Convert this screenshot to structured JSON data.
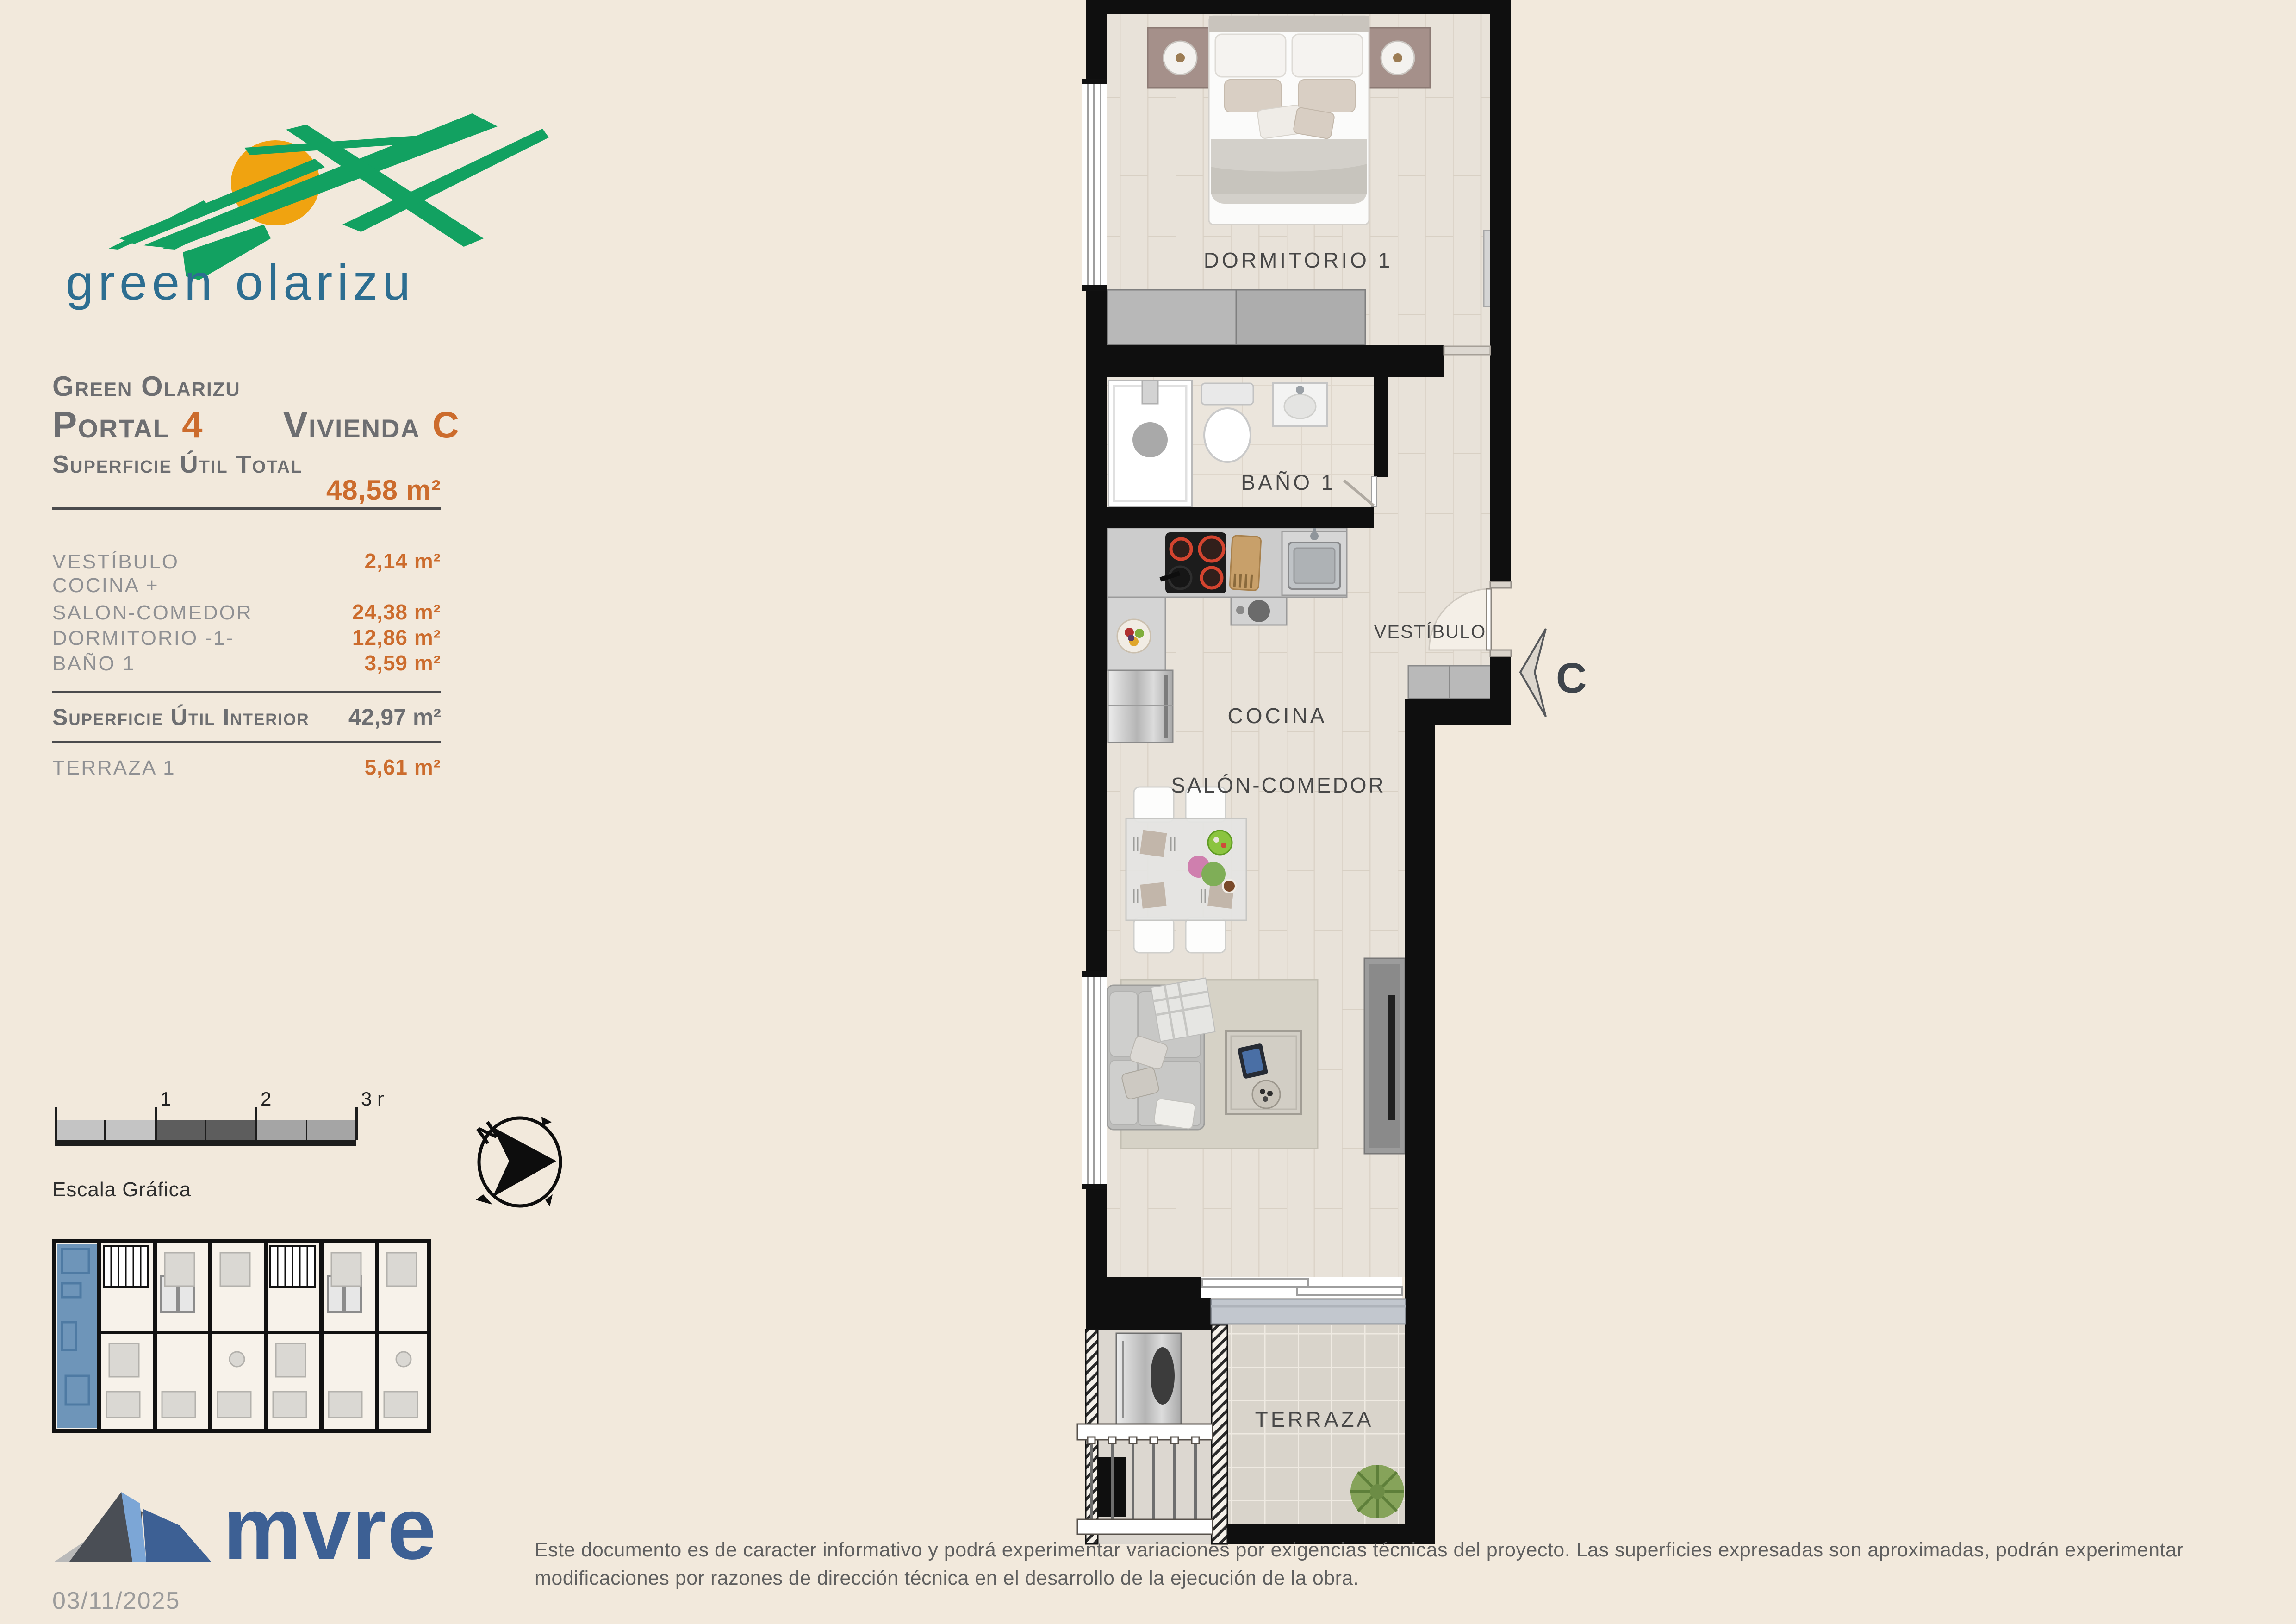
{
  "logo": {
    "brand": "green olarizu"
  },
  "info": {
    "project": "Green Olarizu",
    "portal_label": "Portal",
    "portal_number": "4",
    "vivienda_label": "Vivienda",
    "vivienda_letter": "C",
    "total_label": "Superficie Útil Total",
    "total_value": "48,58 m²",
    "rooms": [
      {
        "label": "VESTÍBULO",
        "value": "2,14 m²"
      },
      {
        "label": "COCINA +",
        "value": ""
      },
      {
        "label": "SALON-COMEDOR",
        "value": "24,38 m²"
      },
      {
        "label": "DORMITORIO -1-",
        "value": "12,86 m²"
      },
      {
        "label": "BAÑO 1",
        "value": "3,59 m²"
      }
    ],
    "interior_label": "Superficie Útil Interior",
    "interior_value": "42,97 m²",
    "terrace_label": "TERRAZA 1",
    "terrace_value": "5,61 m²"
  },
  "scalebar": {
    "caption": "Escala Gráfica",
    "ticks": [
      "1",
      "2",
      "3 m."
    ]
  },
  "compass": {
    "north": "N"
  },
  "plan": {
    "rooms": {
      "bedroom": "DORMITORIO 1",
      "bath": "BAÑO 1",
      "hall": "VESTÍBULO",
      "kitchen": "COCINA",
      "living": "SALÓN-COMEDOR",
      "terrace": "TERRAZA"
    },
    "entrance_letter": "C"
  },
  "footer": {
    "brand": "mvre",
    "date": "03/11/2025",
    "disclaimer": "Este documento es de caracter informativo y podrá experimentar variaciones por exigencias técnicas del proyecto. Las superficies expresadas son aproximadas, podrán experimentar modificaciones por razones de dirección técnica en el desarrollo de la ejecución de la obra."
  },
  "colors": {
    "background": "#f2e9dc",
    "accent_orange": "#cc6c2d",
    "text_gray": "#6d6e71",
    "item_gray": "#8f9093",
    "brand_teal": "#2d6e91",
    "brand_green": "#12a161",
    "sun_orange": "#f0a310",
    "mvre_blue": "#3d6094",
    "highlight_blue": "#6e95b9",
    "wall_black": "#0f0f0f"
  }
}
